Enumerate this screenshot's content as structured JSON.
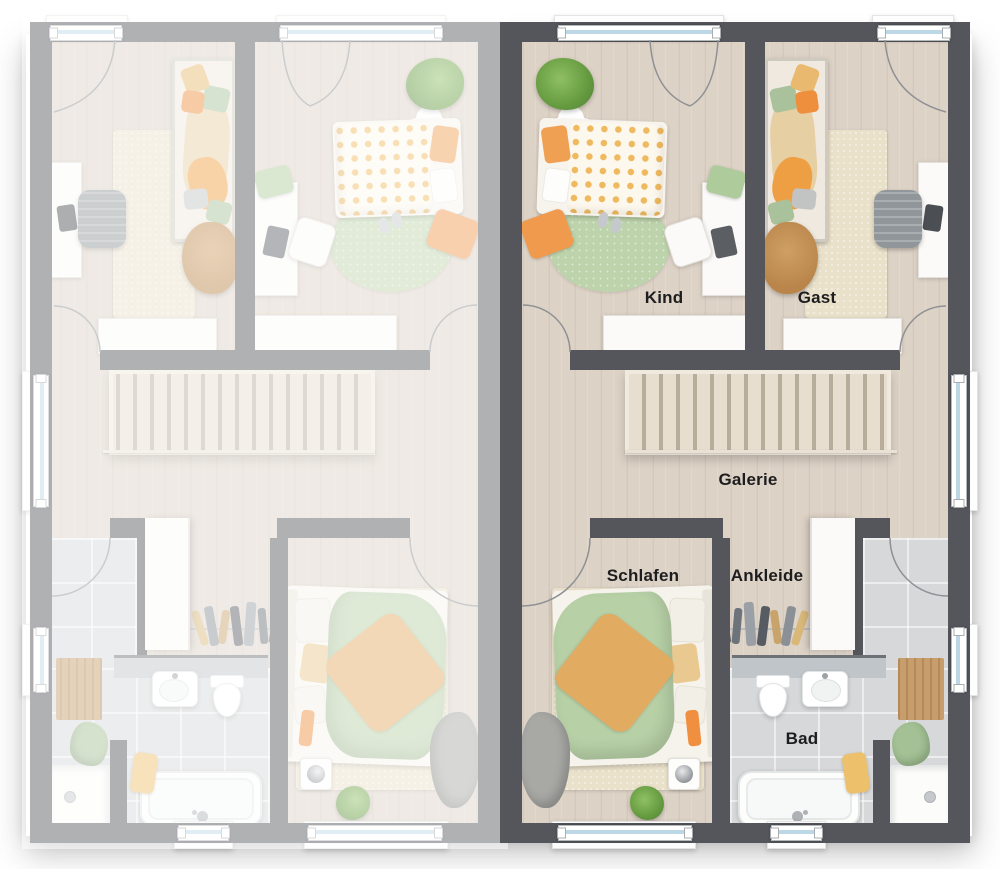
{
  "view": {
    "kind": "floor-plan",
    "orientation": "top-down"
  },
  "rooms": {
    "kind": {
      "label": "Kind"
    },
    "gast": {
      "label": "Gast"
    },
    "galerie": {
      "label": "Galerie"
    },
    "schlafen": {
      "label": "Schlafen"
    },
    "ankleide": {
      "label": "Ankleide"
    },
    "bad": {
      "label": "Bad"
    }
  },
  "units": {
    "right": {
      "style": "highlighted",
      "labels_visible": true
    },
    "left": {
      "style": "faded-mirror",
      "labels_visible": false
    }
  },
  "colors": {
    "wall": "#54565b",
    "floor_wood": "#ddd2c6",
    "floor_tile": "#d6d8d9",
    "window_glass": "#bcd8e6",
    "accent_orange": "#ef9a4d",
    "accent_green": "#b5cfa4",
    "fade_overlay": "rgba(255,255,255,0.54)"
  }
}
